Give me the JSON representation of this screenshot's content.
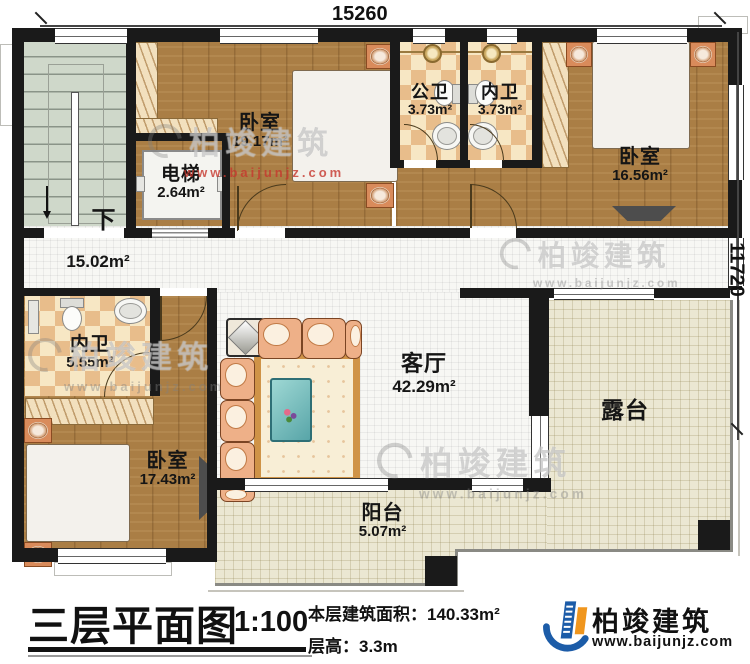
{
  "plan": {
    "dimensions": {
      "width_mm": "15260",
      "height_mm": "11720"
    },
    "stairs": {
      "down": "下"
    },
    "rooms": {
      "bedroom_top": {
        "name": "卧室",
        "area": "19.17m²"
      },
      "public_bath": {
        "name": "公卫",
        "area": "3.73m²"
      },
      "inner_bath_top": {
        "name": "内卫",
        "area": "3.73m²"
      },
      "bedroom_right": {
        "name": "卧室",
        "area": "16.56m²"
      },
      "elevator": {
        "name": "电梯",
        "area": "2.64m²"
      },
      "hall": {
        "area": "15.02m²"
      },
      "inner_bath_mid": {
        "name": "内卫",
        "area": "5.55m²"
      },
      "bedroom_left": {
        "name": "卧室",
        "area": "17.43m²"
      },
      "living": {
        "name": "客厅",
        "area": "42.29m²"
      },
      "terrace": {
        "name": "露台"
      },
      "balcony": {
        "name": "阳台",
        "area": "5.07m²"
      }
    }
  },
  "watermark": {
    "brand": "柏竣建筑",
    "url": "www.baijunjz.com"
  },
  "footer": {
    "title": "三层平面图",
    "scale": "1:100",
    "area_line": "本层建筑面积：140.33m²",
    "height_line": "层高：3.3m"
  },
  "logo": {
    "name": "柏竣建筑",
    "url": "www.baijunjz.com"
  },
  "colors": {
    "wall": "#1a1a1a",
    "wood_floor": "#aa7e45",
    "tile": "#e8bd8b",
    "stairs": "#cfd8ca",
    "terrace": "#ebe7d2",
    "bed": "#62b8d8",
    "sofa": "#eeb088",
    "logo_blue": "#1c5ca8",
    "logo_orange": "#f0961e",
    "watermark_red": "#c6372d"
  }
}
